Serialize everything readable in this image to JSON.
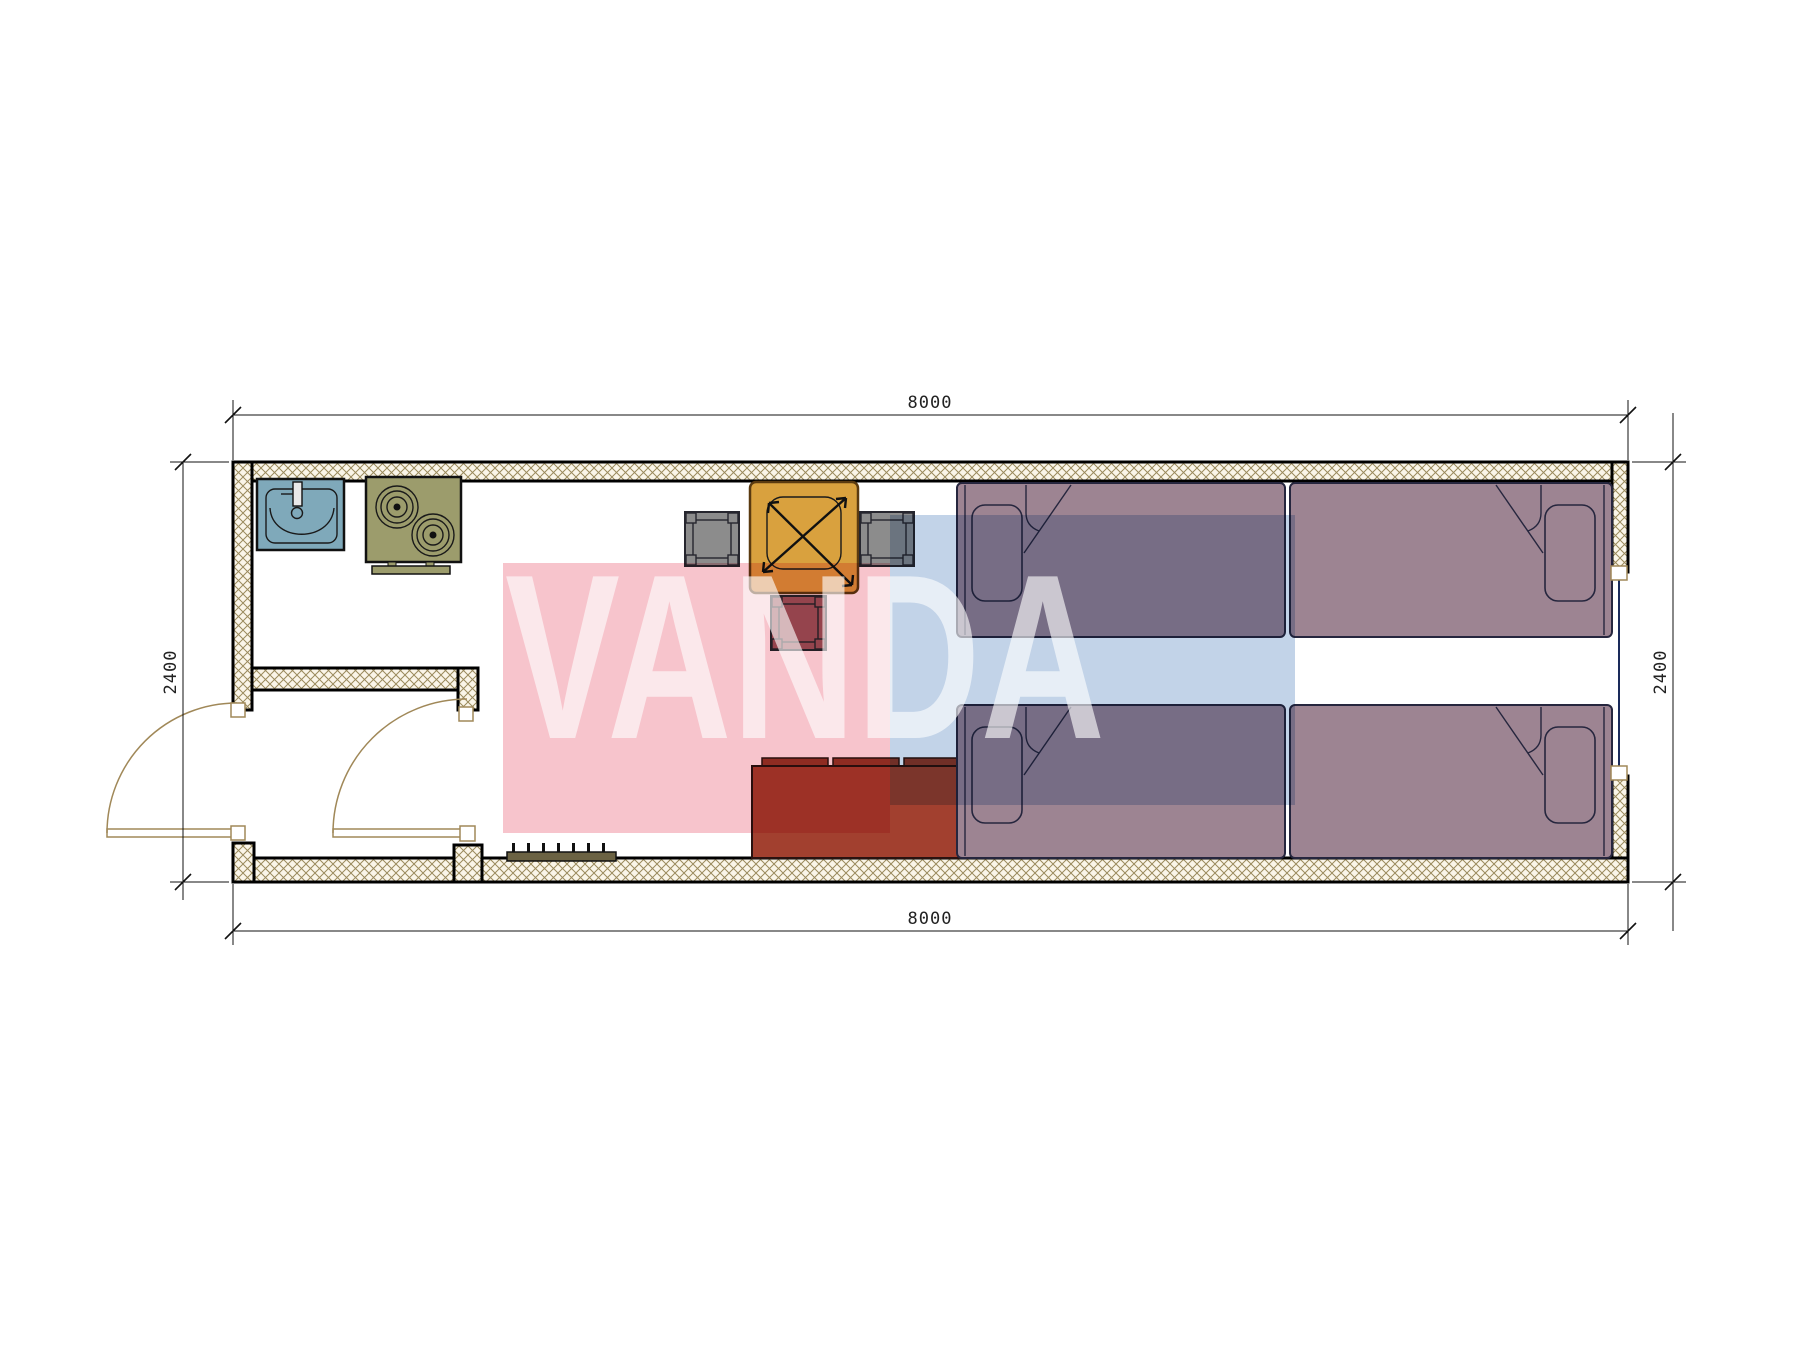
{
  "drawing": {
    "type": "floor-plan",
    "description": "Single-module container house plan, kitchenette and entry at left, four single beds at right",
    "unit": "mm"
  },
  "dimensions": {
    "width_top": "8000",
    "width_bottom": "8000",
    "height_left": "2400",
    "height_right": "2400"
  },
  "watermark": {
    "text": "VANDA"
  },
  "furniture": [
    {
      "name": "sink"
    },
    {
      "name": "stove-two-burner"
    },
    {
      "name": "dining-table"
    },
    {
      "name": "chair-left"
    },
    {
      "name": "chair-right"
    },
    {
      "name": "stool"
    },
    {
      "name": "sofa-three-seat"
    },
    {
      "name": "coat-rack"
    },
    {
      "name": "bed-top-left"
    },
    {
      "name": "bed-bottom-left"
    },
    {
      "name": "bed-top-right"
    },
    {
      "name": "bed-bottom-right"
    },
    {
      "name": "entry-door"
    },
    {
      "name": "interior-door"
    },
    {
      "name": "window-right-wall"
    }
  ],
  "colors": {
    "ink": "#222222",
    "dimline": "#111111",
    "wallbg": "#faf5e8",
    "wallhatch": "#9a8a5c",
    "doorline": "#a08858",
    "window": "#1a2a5a",
    "sink": "#7fa9ba",
    "stove": "#9c9c6c",
    "table": "#d9a13e",
    "chair": "#8c8c8c",
    "stool": "#9a5860",
    "sofa": "#a2402f",
    "sofadark": "#93392a",
    "rack": "#6b6243",
    "bed": "#9d8492",
    "bedline": "#26263e",
    "wmpink": "#f7c4cc",
    "wmblue": "#c2d3e8"
  }
}
